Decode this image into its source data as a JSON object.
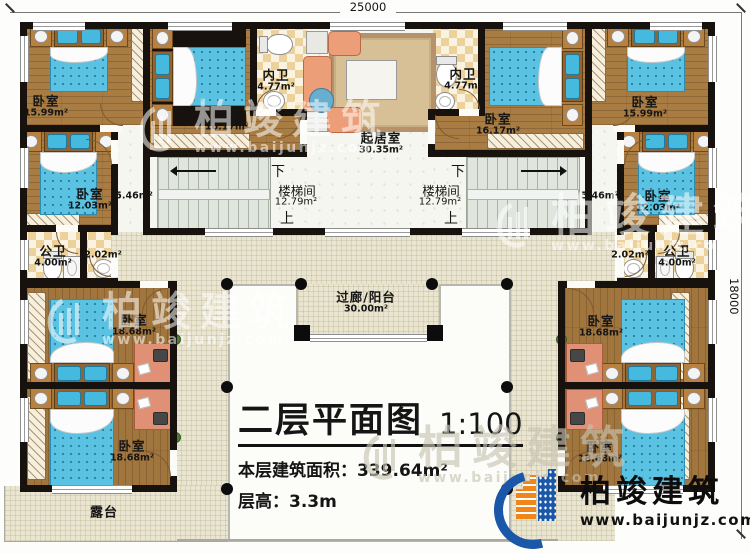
{
  "plan": {
    "dimension_top": "25000",
    "dimension_right": "18000"
  },
  "title_block": {
    "title": "二层平面图",
    "scale": "1:100",
    "area_label": "本层建筑面积：",
    "area_value": "339.64m²",
    "height_label": "层高：",
    "height_value": "3.3m"
  },
  "branding": {
    "company": "柏竣建筑",
    "website": "www.baijunjz.com"
  },
  "watermark": {
    "company": "柏竣建筑",
    "website": "www.baijunjz.com"
  },
  "stair": {
    "name": "楼梯间",
    "area": "12.79m²",
    "down": "下",
    "up": "上"
  },
  "rooms": {
    "bedroom_tl1": {
      "name": "卧室",
      "area": "15.99m²"
    },
    "bedroom_tl2": {
      "name": "卧室",
      "area": "16.17m²"
    },
    "bedroom_tr1": {
      "name": "卧室",
      "area": "15.99m²"
    },
    "bedroom_tr2": {
      "name": "卧室",
      "area": "16.17m²"
    },
    "bedroom_ml": {
      "name": "卧室",
      "area": "12.03m²"
    },
    "bedroom_mr": {
      "name": "卧室",
      "area": "12.03m²"
    },
    "bedroom_wl1": {
      "name": "卧室",
      "area": "18.68m²"
    },
    "bedroom_wl2": {
      "name": "卧室",
      "area": "18.68m²"
    },
    "bedroom_wr1": {
      "name": "卧室",
      "area": "18.68m²"
    },
    "bedroom_wr2": {
      "name": "卧室",
      "area": "18.68m²"
    },
    "bath_inner_l": {
      "name": "内卫",
      "area": "4.77m²"
    },
    "bath_inner_r": {
      "name": "内卫",
      "area": "4.77m²"
    },
    "bath_public_l": {
      "name": "公卫",
      "area": "4.00m²"
    },
    "bath_public_r": {
      "name": "公卫",
      "area": "4.00m²"
    },
    "closet_l": {
      "area": "2.02m²"
    },
    "closet_r": {
      "area": "2.02m²"
    },
    "hall_l": {
      "area": "5.46m²"
    },
    "hall_r": {
      "area": "5.46m²"
    },
    "living": {
      "name": "起居室",
      "area": "30.35m²"
    },
    "corridor": {
      "name": "过廊/阳台",
      "area": "30.00m²"
    },
    "terrace": {
      "name": "露台"
    }
  }
}
